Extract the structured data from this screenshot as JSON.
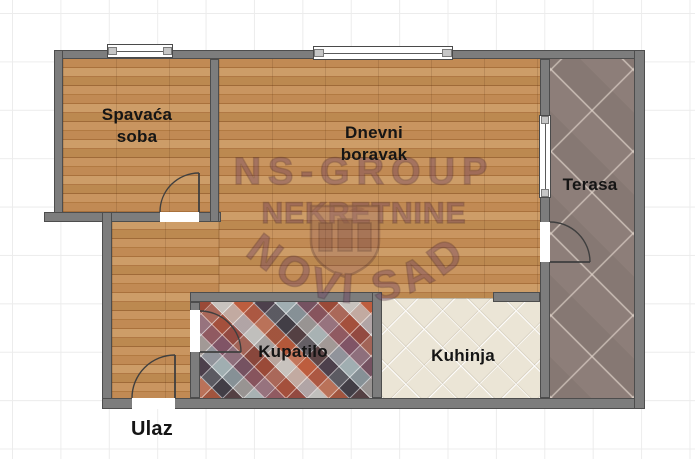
{
  "plan": {
    "rooms": {
      "bedroom": {
        "line1": "Spavaća",
        "line2": "soba"
      },
      "living_room": {
        "line1": "Dnevni",
        "line2": "boravak"
      },
      "terrace": {
        "label": "Terasa"
      },
      "bathroom": {
        "label": "Kupatilo"
      },
      "kitchen": {
        "label": "Kuhinja"
      }
    },
    "entrance": {
      "label": "Ulaz"
    }
  },
  "watermark": {
    "line1": "NS-GROUP",
    "line2": "NEKRETNINE",
    "arc_text": "NOVI SAD"
  },
  "colors": {
    "wall": "#7d7d7d",
    "wall_outline": "#4d4d4d",
    "wood_floor": "#bf8a55",
    "kitchen_tile": "#ebe5d6",
    "terrace_tile": "#8d7e79",
    "mosaic_accent": "#c05a3a",
    "grid_line": "#ececec",
    "label_text": "#151515",
    "watermark": "#6f4160"
  }
}
